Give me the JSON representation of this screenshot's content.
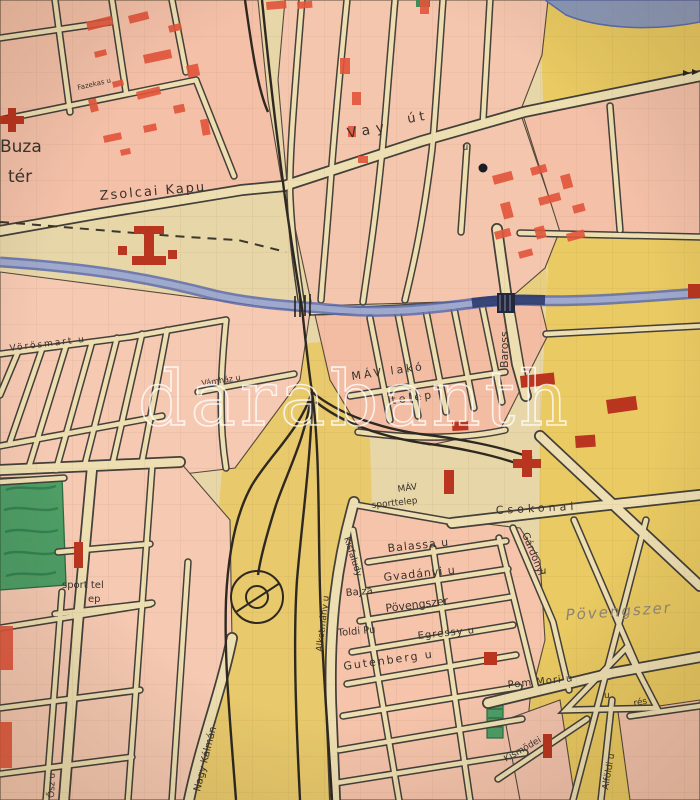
{
  "map": {
    "type": "hand-drawn city map scan",
    "watermark": {
      "text": "darabanth"
    },
    "labels": [
      {
        "id": "street-fazekas",
        "text": "Fazekas u"
      },
      {
        "id": "square-buza-line1",
        "text": "Buza"
      },
      {
        "id": "square-buza-line2",
        "text": "tér"
      },
      {
        "id": "street-zsolcai-kapu",
        "text": "Zsolcai Kapu"
      },
      {
        "id": "street-vay-1",
        "text": "Vay"
      },
      {
        "id": "street-vay-2",
        "text": "út"
      },
      {
        "id": "street-vay-u",
        "text": "u"
      },
      {
        "id": "street-baross",
        "text": "Baross"
      },
      {
        "id": "area-mav-lako",
        "text": "MÁV lakó"
      },
      {
        "id": "area-mav-telep",
        "text": "telep"
      },
      {
        "id": "street-vamhaz",
        "text": "Vámház u"
      },
      {
        "id": "street-vorosmart",
        "text": "Vörösmart u"
      },
      {
        "id": "area-mav-sport-1",
        "text": "MÁV"
      },
      {
        "id": "area-mav-sport-2",
        "text": "sporttelep"
      },
      {
        "id": "street-csokonai",
        "text": "Csokonai"
      },
      {
        "id": "street-balassa",
        "text": "Balassa u"
      },
      {
        "id": "street-gvadanyi",
        "text": "Gvadányi u"
      },
      {
        "id": "area-povengszer-small",
        "text": "Pövengszer"
      },
      {
        "id": "area-povengszer-big",
        "text": "Pövengszer"
      },
      {
        "id": "street-gardonyi",
        "text": "Gárdonyi"
      },
      {
        "id": "street-gardonyi-u",
        "text": "u"
      },
      {
        "id": "street-kisfaludy",
        "text": "Kisfaludy"
      },
      {
        "id": "street-bajza",
        "text": "Bajza"
      },
      {
        "id": "street-alkotmany",
        "text": "Alkotmány u"
      },
      {
        "id": "street-toldi",
        "text": "Toldi Pu"
      },
      {
        "id": "street-egressy",
        "text": "Egressy u"
      },
      {
        "id": "street-gutenberg",
        "text": "Gutenberg u"
      },
      {
        "id": "street-pommori",
        "text": "Pom Mori u"
      },
      {
        "id": "area-res",
        "text": "rés"
      },
      {
        "id": "street-u-mark",
        "text": "u"
      },
      {
        "id": "street-kismodei",
        "text": "Kismödei"
      },
      {
        "id": "street-alfoldi",
        "text": "Alföldi u"
      },
      {
        "id": "street-osz",
        "text": "Ősz u"
      },
      {
        "id": "street-nagy-kalman",
        "text": "Nagy Kálmán"
      },
      {
        "id": "area-sporttelep-1",
        "text": "sport tel"
      },
      {
        "id": "area-sporttelep-2",
        "text": "ep"
      }
    ],
    "colors": {
      "paper": "#e7d6a8",
      "street": "#eedfb2",
      "block_pink": "#f4c0a8",
      "fields_yellow": "#eac95e",
      "park_green": "#4e9e66",
      "river_blue": "#5c6cae",
      "building_red_light": "#e2563c",
      "building_red_dark": "#b9351f",
      "ink": "#39322a",
      "watermark_white": "#ffffff"
    }
  }
}
